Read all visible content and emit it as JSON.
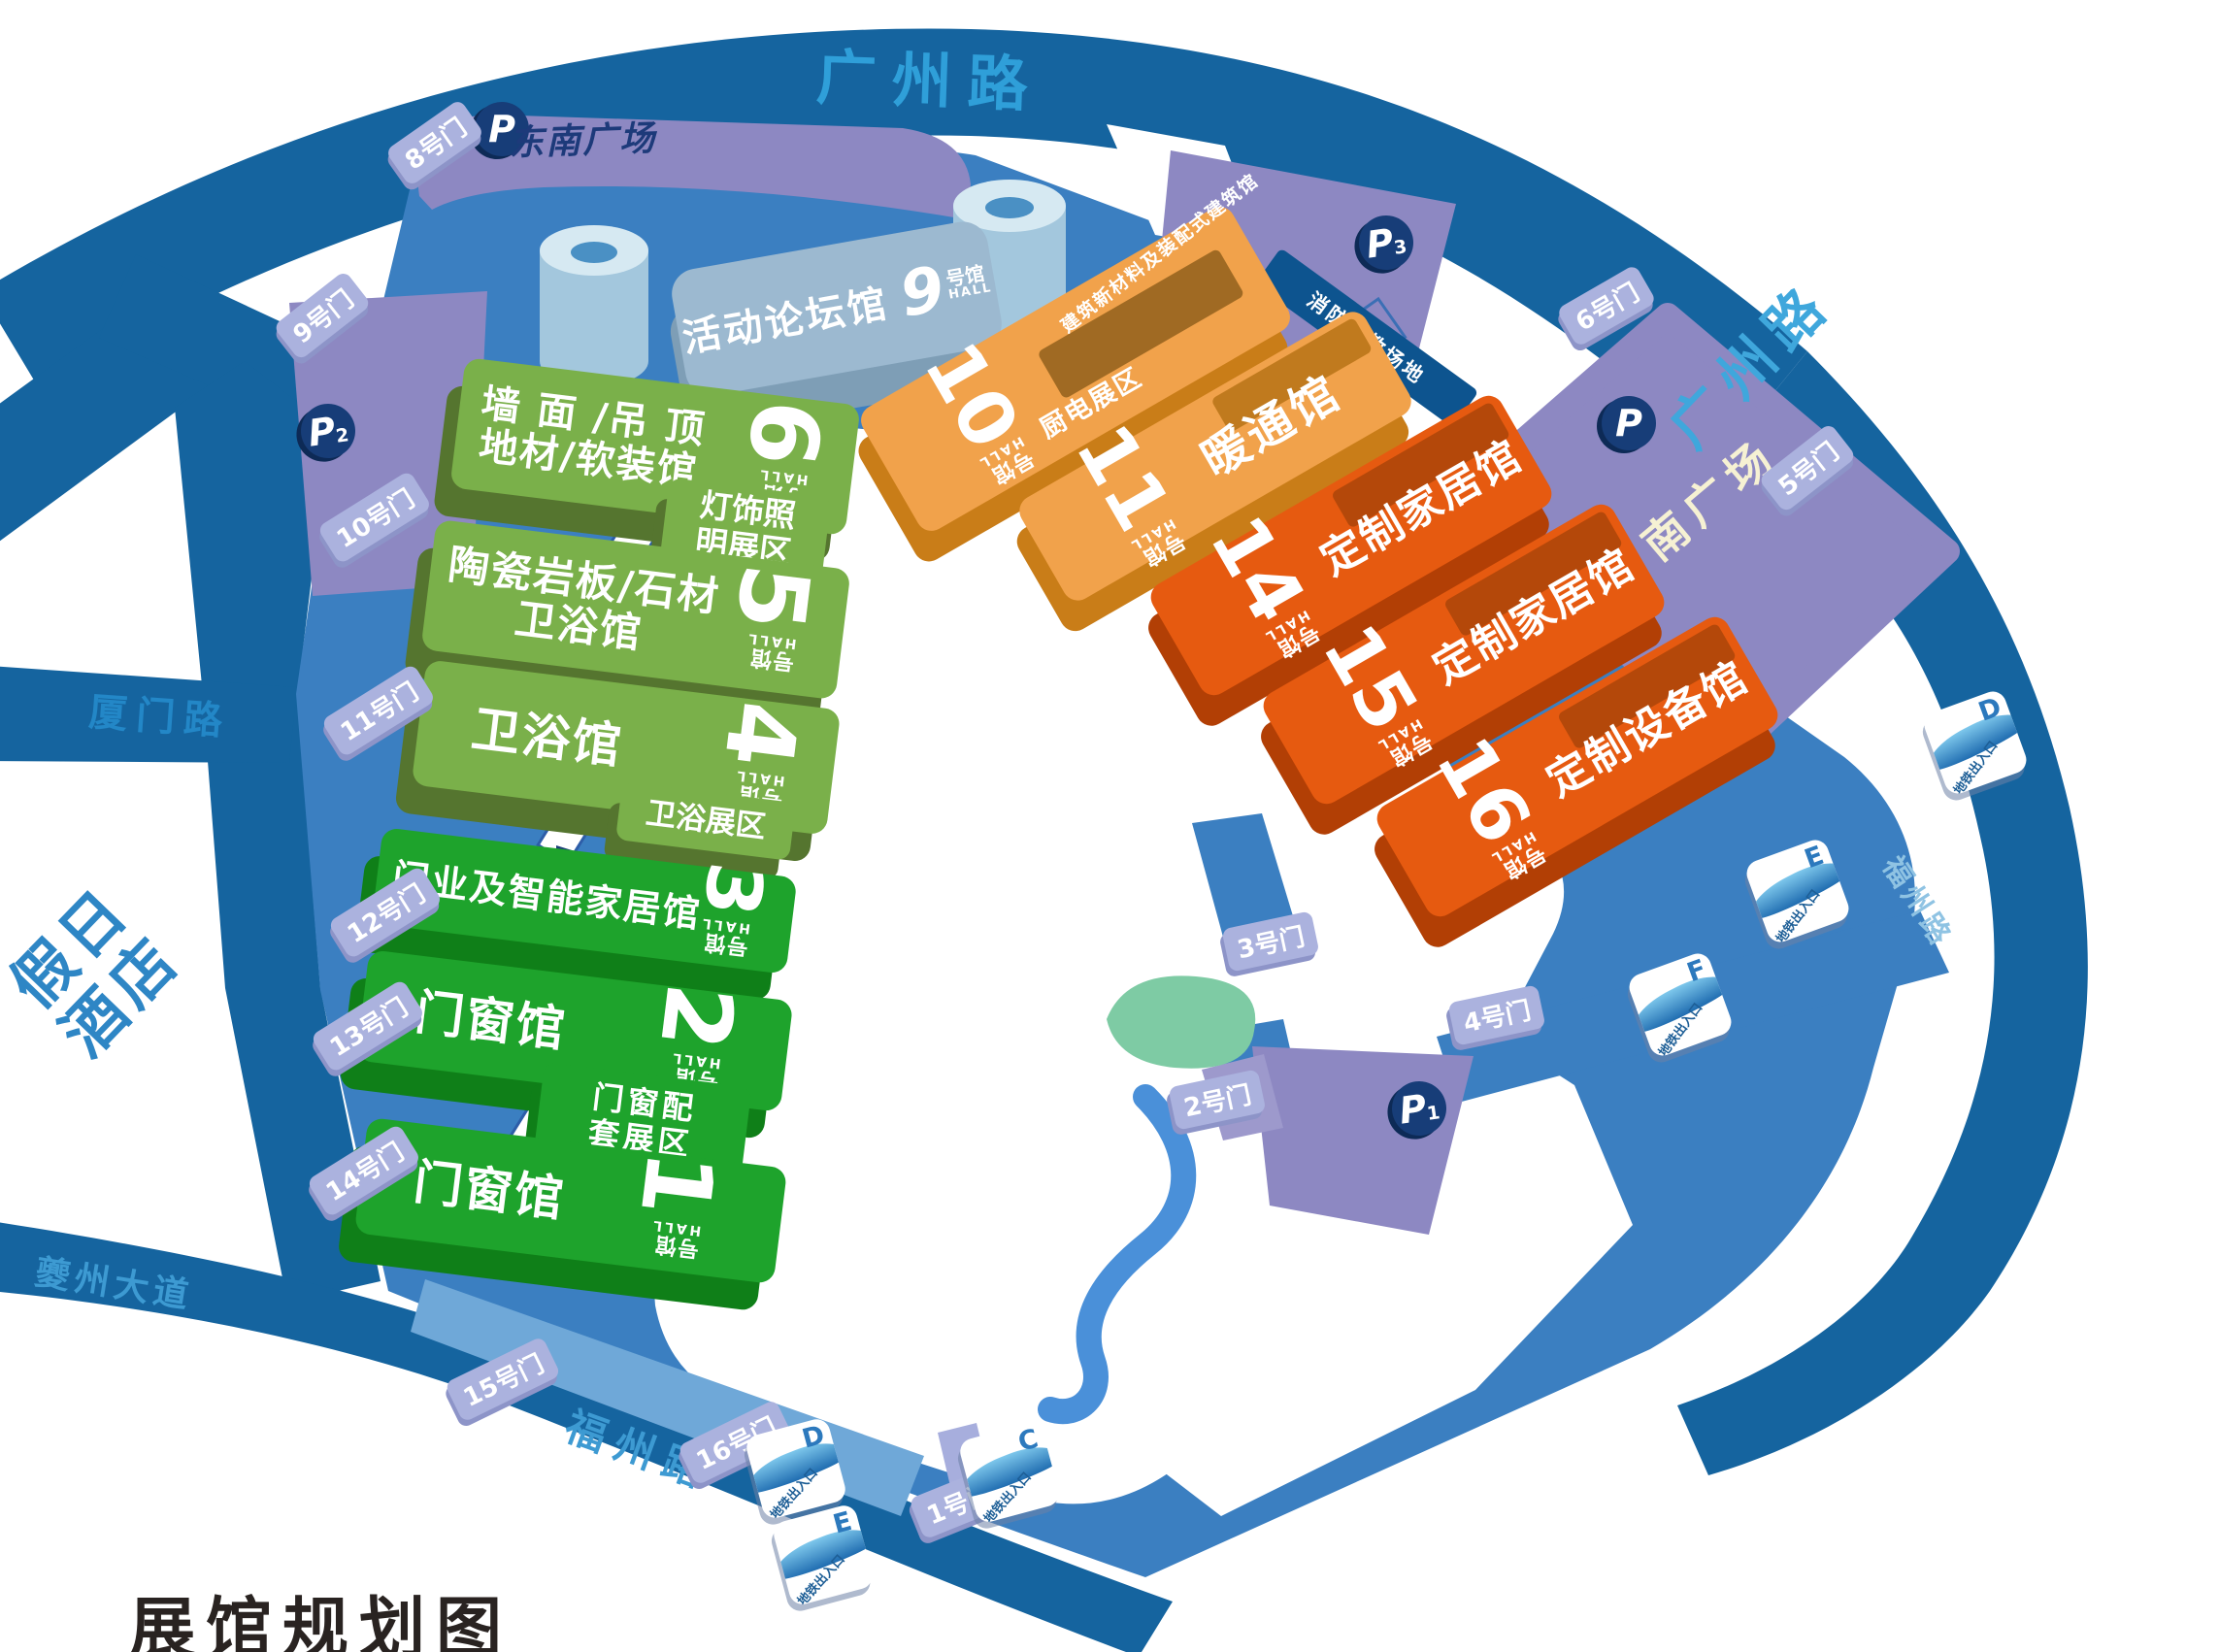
{
  "title": "展馆规划图",
  "roads": {
    "top": "广州路",
    "right": "广州路",
    "xiamen": "厦门路",
    "kuizhou": "夔州大道",
    "fuzhou_bottom": "福州路",
    "fuzhou_right": "福州路"
  },
  "hotel": {
    "line1": "假日",
    "line2": "酒店"
  },
  "plazas": {
    "southeast": "东南广场",
    "south": "南广场"
  },
  "parking": {
    "p_letter": "P",
    "p1_sub": "1",
    "p2_sub": "2",
    "p3_sub": "3"
  },
  "fire_area": "消防演教场地",
  "subway": {
    "label": "地铁出入口",
    "d": "D",
    "e": "E",
    "f": "F",
    "c": "C"
  },
  "gates": {
    "g1": "1号门",
    "g2": "2号门",
    "g3": "3号门",
    "g4": "4号门",
    "g5": "5号门",
    "g6": "6号门",
    "g8": "8号门",
    "g9": "9号门",
    "g10": "10号门",
    "g11": "11号门",
    "g12": "12号门",
    "g13": "13号门",
    "g14": "14号门",
    "g15": "15号门",
    "g16": "16号门"
  },
  "hall9": {
    "name": "活动论坛馆",
    "num": "9",
    "unit": "号馆",
    "hall": "HALL"
  },
  "halls_green": [
    {
      "line1": "墙 面 /吊 顶",
      "line2": "地材/软装馆",
      "num": "6",
      "unit": "号馆",
      "hall": "HALL"
    },
    {
      "line1": "陶瓷岩板/石材",
      "line2": "卫浴馆",
      "num": "5",
      "unit": "号馆",
      "hall": "HALL"
    },
    {
      "line1": "卫浴馆",
      "num": "4",
      "unit": "号馆",
      "hall": "HALL"
    },
    {
      "line1": "门业及智能家居馆",
      "num": "3",
      "unit": "号馆",
      "hall": "HALL"
    },
    {
      "line1": "门窗馆",
      "num": "2",
      "unit": "号馆",
      "hall": "HALL"
    },
    {
      "line1": "门窗馆",
      "num": "1",
      "unit": "号馆",
      "hall": "HALL"
    }
  ],
  "zones": {
    "lighting1": "灯饰照",
    "lighting2": "明展区",
    "bath": "卫浴展区",
    "window1": "门窗配",
    "window2": "套展区",
    "kitchen": "厨电展区"
  },
  "halls_orange": [
    {
      "name": "建筑新材料及装配式建筑馆",
      "num": "10",
      "unit": "号馆",
      "hall": "HALL"
    },
    {
      "name": "暖通馆",
      "num": "11",
      "unit": "号馆",
      "hall": "HALL"
    },
    {
      "name": "定制家居馆",
      "num": "14",
      "unit": "号馆",
      "hall": "HALL"
    },
    {
      "name": "定制家居馆",
      "num": "15",
      "unit": "号馆",
      "hall": "HALL"
    },
    {
      "name": "定制设备馆",
      "num": "16",
      "unit": "号馆",
      "hall": "HALL"
    }
  ],
  "colors": {
    "road_dark_blue": "#15649f",
    "venue_blue": "#3b7fc1",
    "venue_blue_light": "#6fa8d8",
    "purple_area": "#8d88c2",
    "gate_tag": "#abb2de",
    "green_light": "#7ab04a",
    "green_vivid": "#1ea32c",
    "orange_light": "#f1a24b",
    "orange_dark": "#e65a10",
    "parking_navy": "#173d78",
    "road_text_blue": "#2f9fd9",
    "south_plaza_text": "#f6f1d3",
    "title_black": "#292321"
  }
}
